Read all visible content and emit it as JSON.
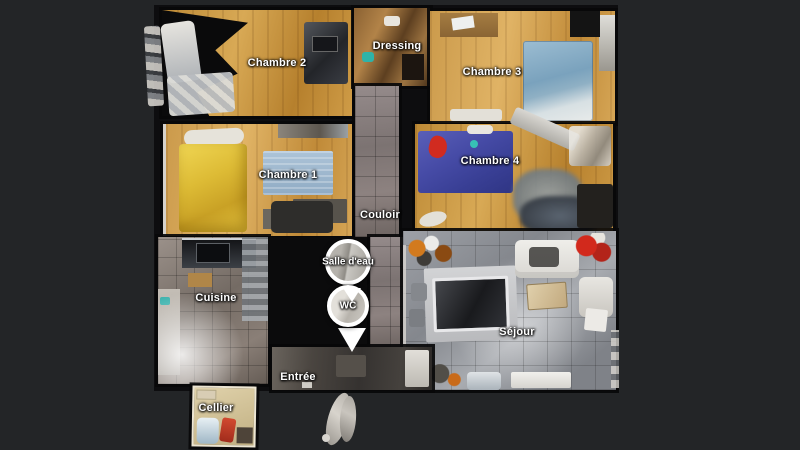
{
  "app": {
    "description": "3D dollhouse floor plan view of an apartment with room labels and navigation pins",
    "background_color": "#232527"
  },
  "floorplan": {
    "rooms": [
      {
        "id": "chambre-2",
        "label": "Chambre 2"
      },
      {
        "id": "dressing",
        "label": "Dressing"
      },
      {
        "id": "chambre-3",
        "label": "Chambre 3"
      },
      {
        "id": "chambre-1",
        "label": "Chambre 1"
      },
      {
        "id": "chambre-4",
        "label": "Chambre 4"
      },
      {
        "id": "couloir",
        "label": "Couloir"
      },
      {
        "id": "cuisine",
        "label": "Cuisine"
      },
      {
        "id": "sejour",
        "label": "Séjour"
      },
      {
        "id": "entree",
        "label": "Entrée"
      },
      {
        "id": "cellier",
        "label": "Cellier"
      }
    ],
    "pins": [
      {
        "id": "salle-deau",
        "label": "Salle d'eau"
      },
      {
        "id": "wc",
        "label": "WC"
      }
    ],
    "colors": {
      "background": "#232527",
      "void_black": "#0d0d0f",
      "wood_warm": "#c6923f",
      "wood_light": "#d3a45b",
      "tile_warm_gray": "#8d8280",
      "tile_cool_gray": "#94969a",
      "bed_blue": "#8fb0c4",
      "bed_purple": "#464ba6",
      "bed_yellow": "#ddbb35",
      "rug_blue": "#9db8cf",
      "pin_border": "#ffffff",
      "label_text": "#ffffff"
    }
  }
}
